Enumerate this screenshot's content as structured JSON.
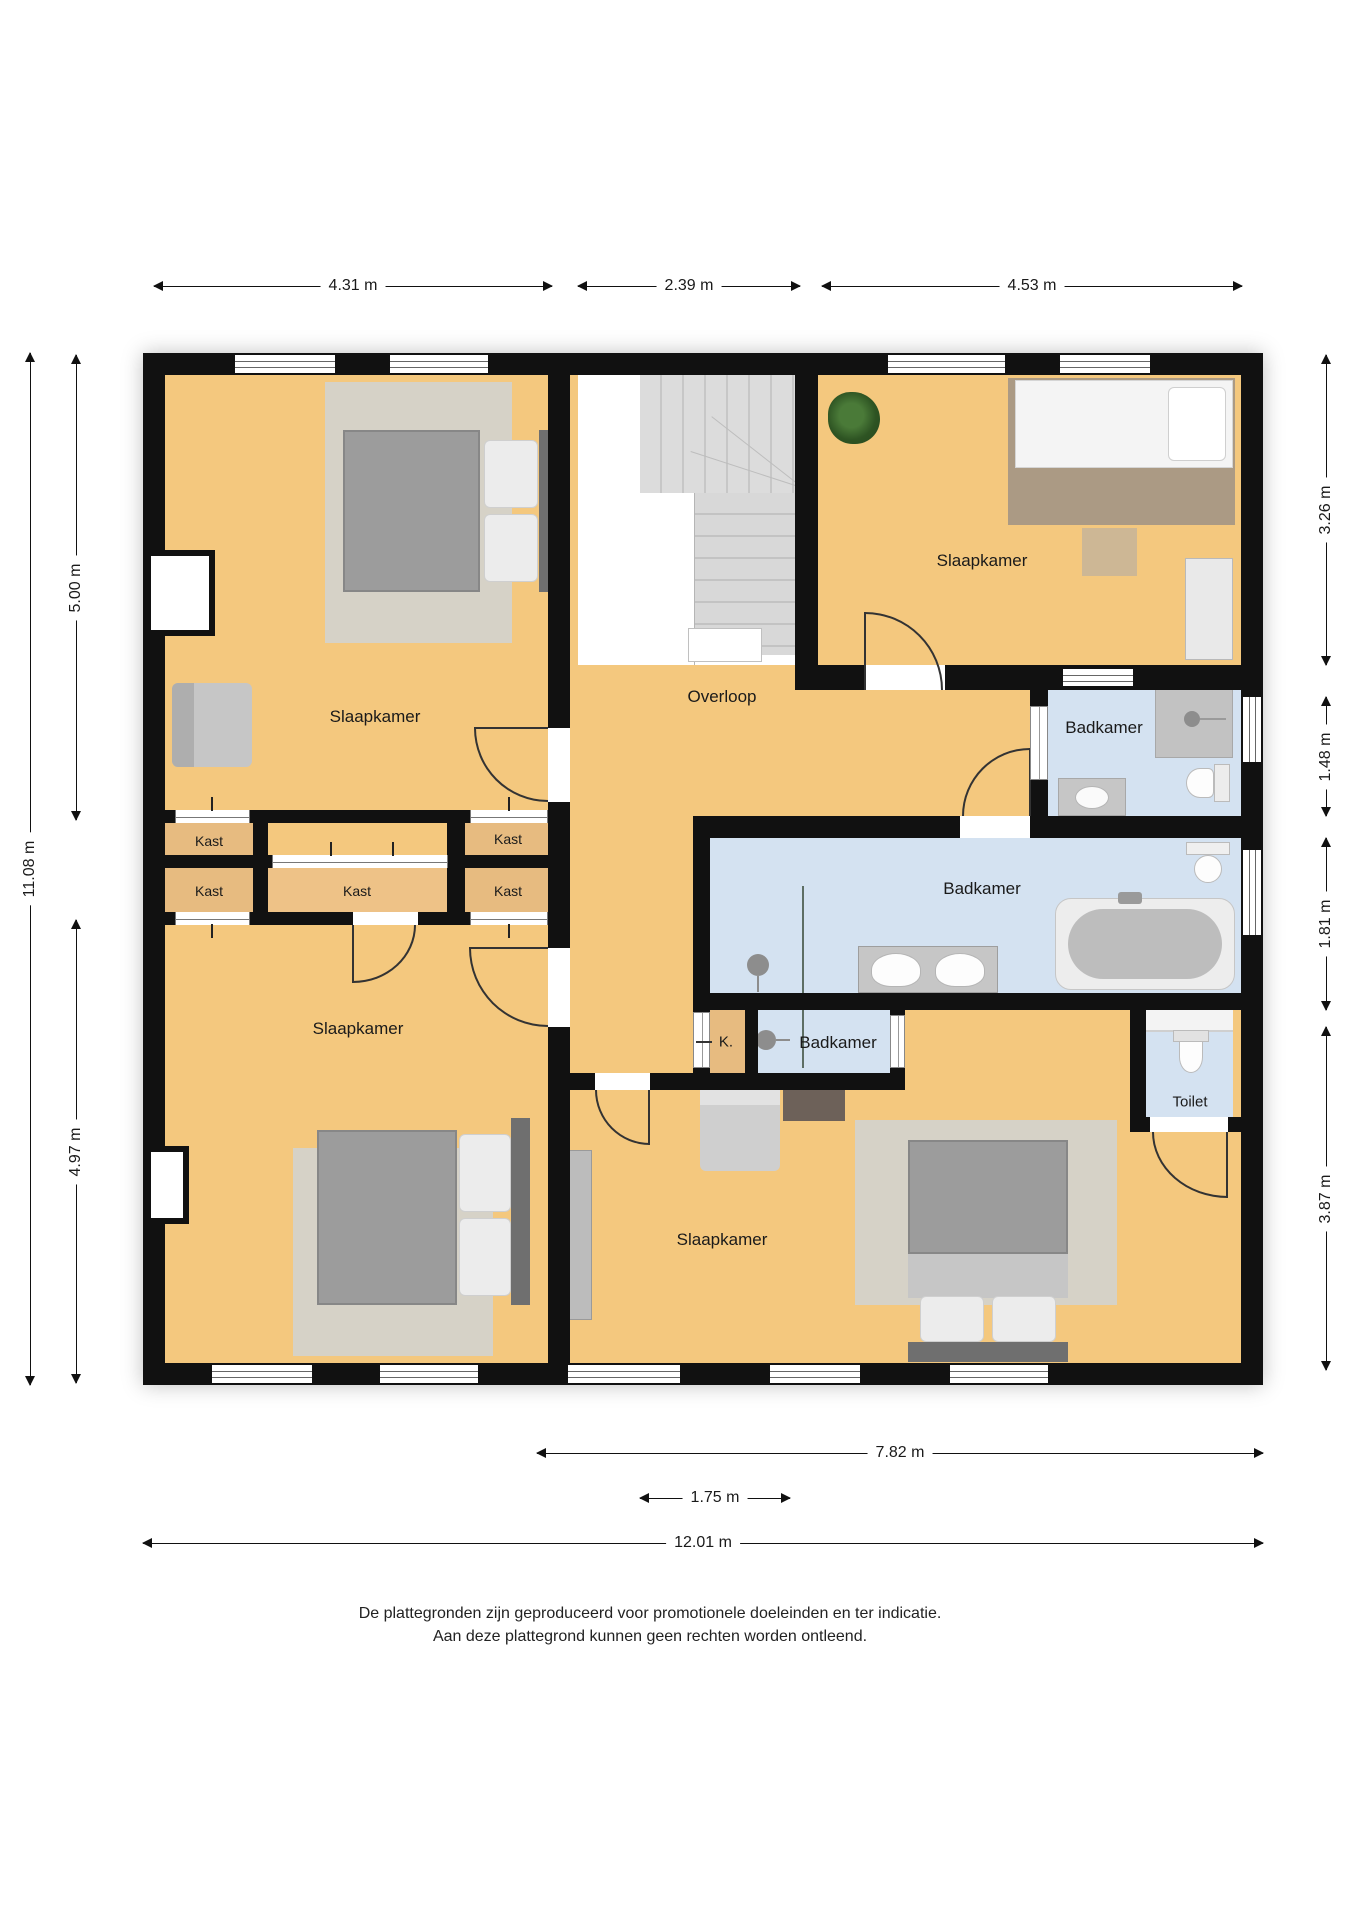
{
  "rooms": {
    "bedroom_top_left": {
      "label": "Slaapkamer"
    },
    "bedroom_top_right": {
      "label": "Slaapkamer"
    },
    "bedroom_bottom_left": {
      "label": "Slaapkamer"
    },
    "bedroom_bottom": {
      "label": "Slaapkamer"
    },
    "landing": {
      "label": "Overloop"
    },
    "bathroom_top": {
      "label": "Badkamer"
    },
    "bathroom_main": {
      "label": "Badkamer"
    },
    "bathroom_small": {
      "label": "Badkamer"
    },
    "toilet": {
      "label": "Toilet"
    },
    "closet_abbr": {
      "label": "K."
    },
    "closets": [
      {
        "label": "Kast"
      },
      {
        "label": "Kast"
      },
      {
        "label": "Kast"
      },
      {
        "label": "Kast"
      },
      {
        "label": "Kast"
      }
    ]
  },
  "dimensions": {
    "top": [
      "4.31 m",
      "2.39 m",
      "4.53 m"
    ],
    "left": [
      "11.08 m",
      "5.00 m",
      "4.97 m"
    ],
    "right": [
      "3.26 m",
      "1.48 m",
      "1.81 m",
      "3.87 m"
    ],
    "bottom": [
      "7.82 m",
      "1.75 m",
      "12.01 m"
    ]
  },
  "footer": {
    "line1": "De plattegronden zijn geproduceerd voor promotionele doeleinden en ter indicatie.",
    "line2": "Aan deze plattegrond kunnen geen rechten worden ontleend."
  },
  "colors": {
    "floor": "#f4c87e",
    "closet": "#e7bb80",
    "closet_center": "#eec287",
    "wall": "#111111",
    "bathroom": "#d4e2f1",
    "stairs": "#d9d9d9",
    "rug": "#d6d2c7",
    "rug_wood": "#ab9a84",
    "glass": "#5d6e64",
    "bed": "#9c9c9c"
  }
}
